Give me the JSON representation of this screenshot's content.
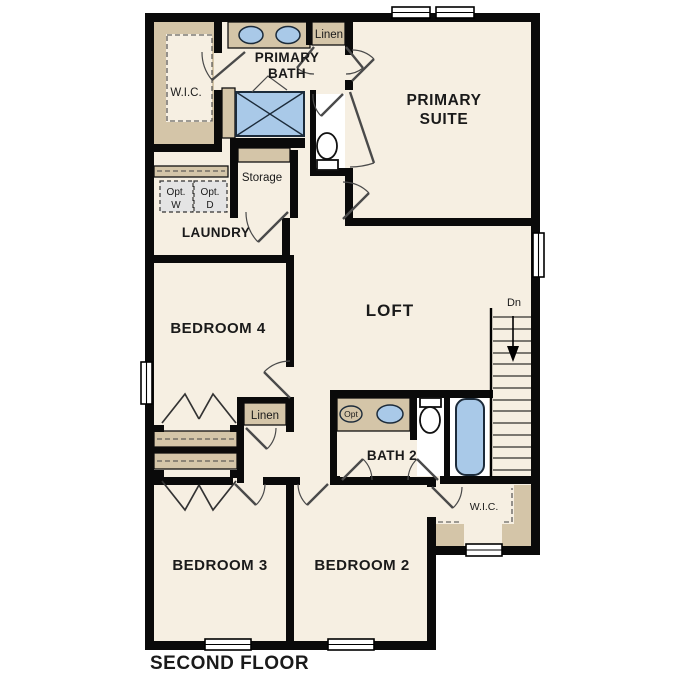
{
  "title": "SECOND FLOOR",
  "colors": {
    "wall": "#0a0a0a",
    "floor": "#f6efe2",
    "casework": "#d4c5a8",
    "fixture_blue": "#a9c9e8",
    "optional_appliance": "#e4e4e4",
    "background": "#ffffff"
  },
  "labels": {
    "primary_bath_1": "PRIMARY",
    "primary_bath_2": "BATH",
    "wic_top": "W.I.C.",
    "linen_top": "Linen",
    "primary_suite_1": "PRIMARY",
    "primary_suite_2": "SUITE",
    "storage": "Storage",
    "opt_w_1": "Opt.",
    "opt_w_2": "W",
    "opt_d_1": "Opt.",
    "opt_d_2": "D",
    "laundry": "LAUNDRY",
    "bedroom4": "BEDROOM 4",
    "loft": "LOFT",
    "stairs_dn": "Dn",
    "linen_hall": "Linen",
    "bath2": "BATH 2",
    "opt_sink": "Opt",
    "wic_bottom": "W.I.C.",
    "bedroom3": "BEDROOM 3",
    "bedroom2": "BEDROOM 2",
    "floor_title": "SECOND FLOOR"
  },
  "stairs": {
    "label": "Dn",
    "direction": "down",
    "treads": 14
  },
  "fixtures": [
    "double-vanity-sinks",
    "shower",
    "primary-toilet",
    "bath2-vanity-sink",
    "optional-sink",
    "bath2-toilet",
    "bathtub",
    "optional-washer",
    "optional-dryer"
  ]
}
